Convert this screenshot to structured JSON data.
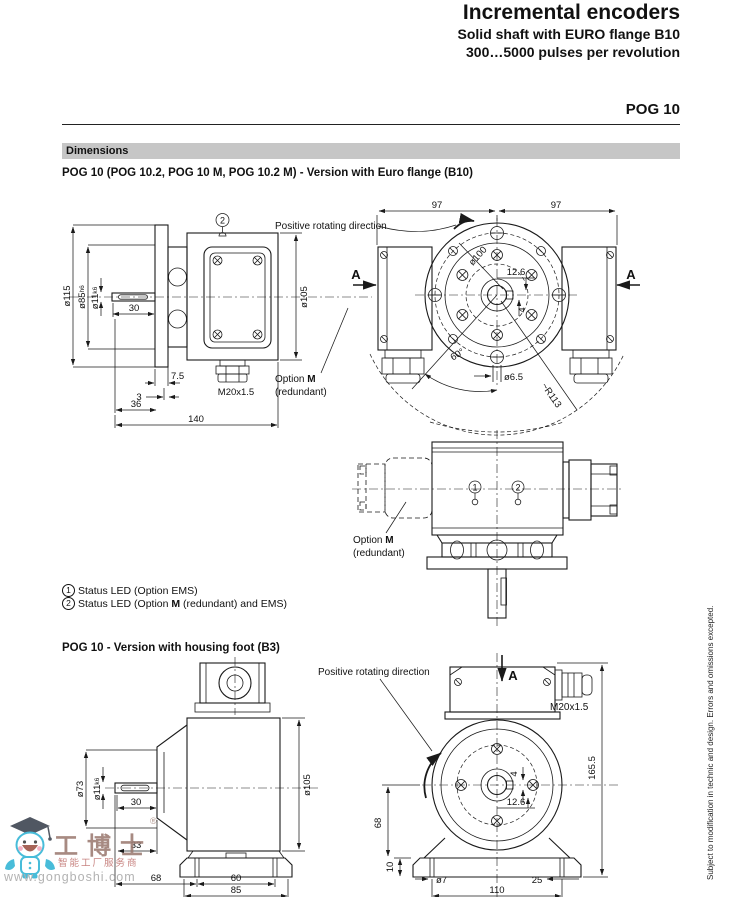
{
  "header": {
    "title": "Incremental encoders",
    "subtitle1": "Solid shaft with EURO flange B10",
    "subtitle2": "300…5000 pulses per revolution",
    "model": "POG 10"
  },
  "dimensions_bar": "Dimensions",
  "euro": {
    "heading": "POG 10 (POG 10.2, POG 10 M, POG 10.2 M) - Version with Euro flange (B10)",
    "side": {
      "marker2": "2",
      "dia115": "ø115",
      "dia85": "ø85",
      "dia85_tol": "h6",
      "dia11": "ø11",
      "dia11_tol": "k6",
      "len30": "30",
      "len7_5": "7.5",
      "len3": "3",
      "len36": "36",
      "len140": "140",
      "gland": "M20x1.5",
      "dia105": "ø105"
    },
    "front": {
      "len97_left": "97",
      "len97_right": "97",
      "rotating_label": "Positive rotating direction",
      "a_left": "A",
      "a_right": "A",
      "dia100": "ø100",
      "len12_6": "12.6",
      "len4": "4",
      "dia6_5": "ø6.5",
      "angle60": "60°",
      "r113": "~R113",
      "option_prefix": "Option ",
      "option_m": "M",
      "option_suffix": "(redundant)"
    },
    "top": {
      "marker1": "1",
      "marker2": "2",
      "option_prefix": "Option ",
      "option_m": "M",
      "option_suffix": "(redundant)"
    }
  },
  "legend": {
    "item1_marker": "1",
    "item1_text": "Status LED (Option EMS)",
    "item2_marker": "2",
    "item2_prefix": "Status LED (Option ",
    "item2_m": "M",
    "item2_suffix": " (redundant) and EMS)"
  },
  "foot": {
    "heading": "POG 10 - Version with housing foot (B3)",
    "side": {
      "dia73": "ø73",
      "dia11": "ø11",
      "dia11_tol": "k6",
      "len30": "30",
      "len33": "33",
      "len68": "68",
      "len60": "60",
      "len85": "85",
      "dia105": "ø105"
    },
    "front": {
      "rotating_label": "Positive rotating direction",
      "a": "A",
      "gland": "M20x1.5",
      "len165_5": "165.5",
      "len4": "4",
      "len12_6": "12.6",
      "len68": "68",
      "len10": "10",
      "dia7": "ø7",
      "len25": "25",
      "len110": "110"
    }
  },
  "sidebar_note": "Subject to modification in technic and design. Errors and omissions excepted.",
  "watermark": {
    "brand": "工博士",
    "registered": "®",
    "tagline": "智能工厂服务商",
    "url": "www.gongboshi.com"
  },
  "colors": {
    "bar_bg": "#c6c6c6",
    "line": "#1a1a1a",
    "watermark_brand": "#9b7a71",
    "watermark_tagline": "#c0736f",
    "watermark_url": "#a8a8a8",
    "mascot_body": "#2fb3d4",
    "mascot_cap": "#39404d"
  }
}
